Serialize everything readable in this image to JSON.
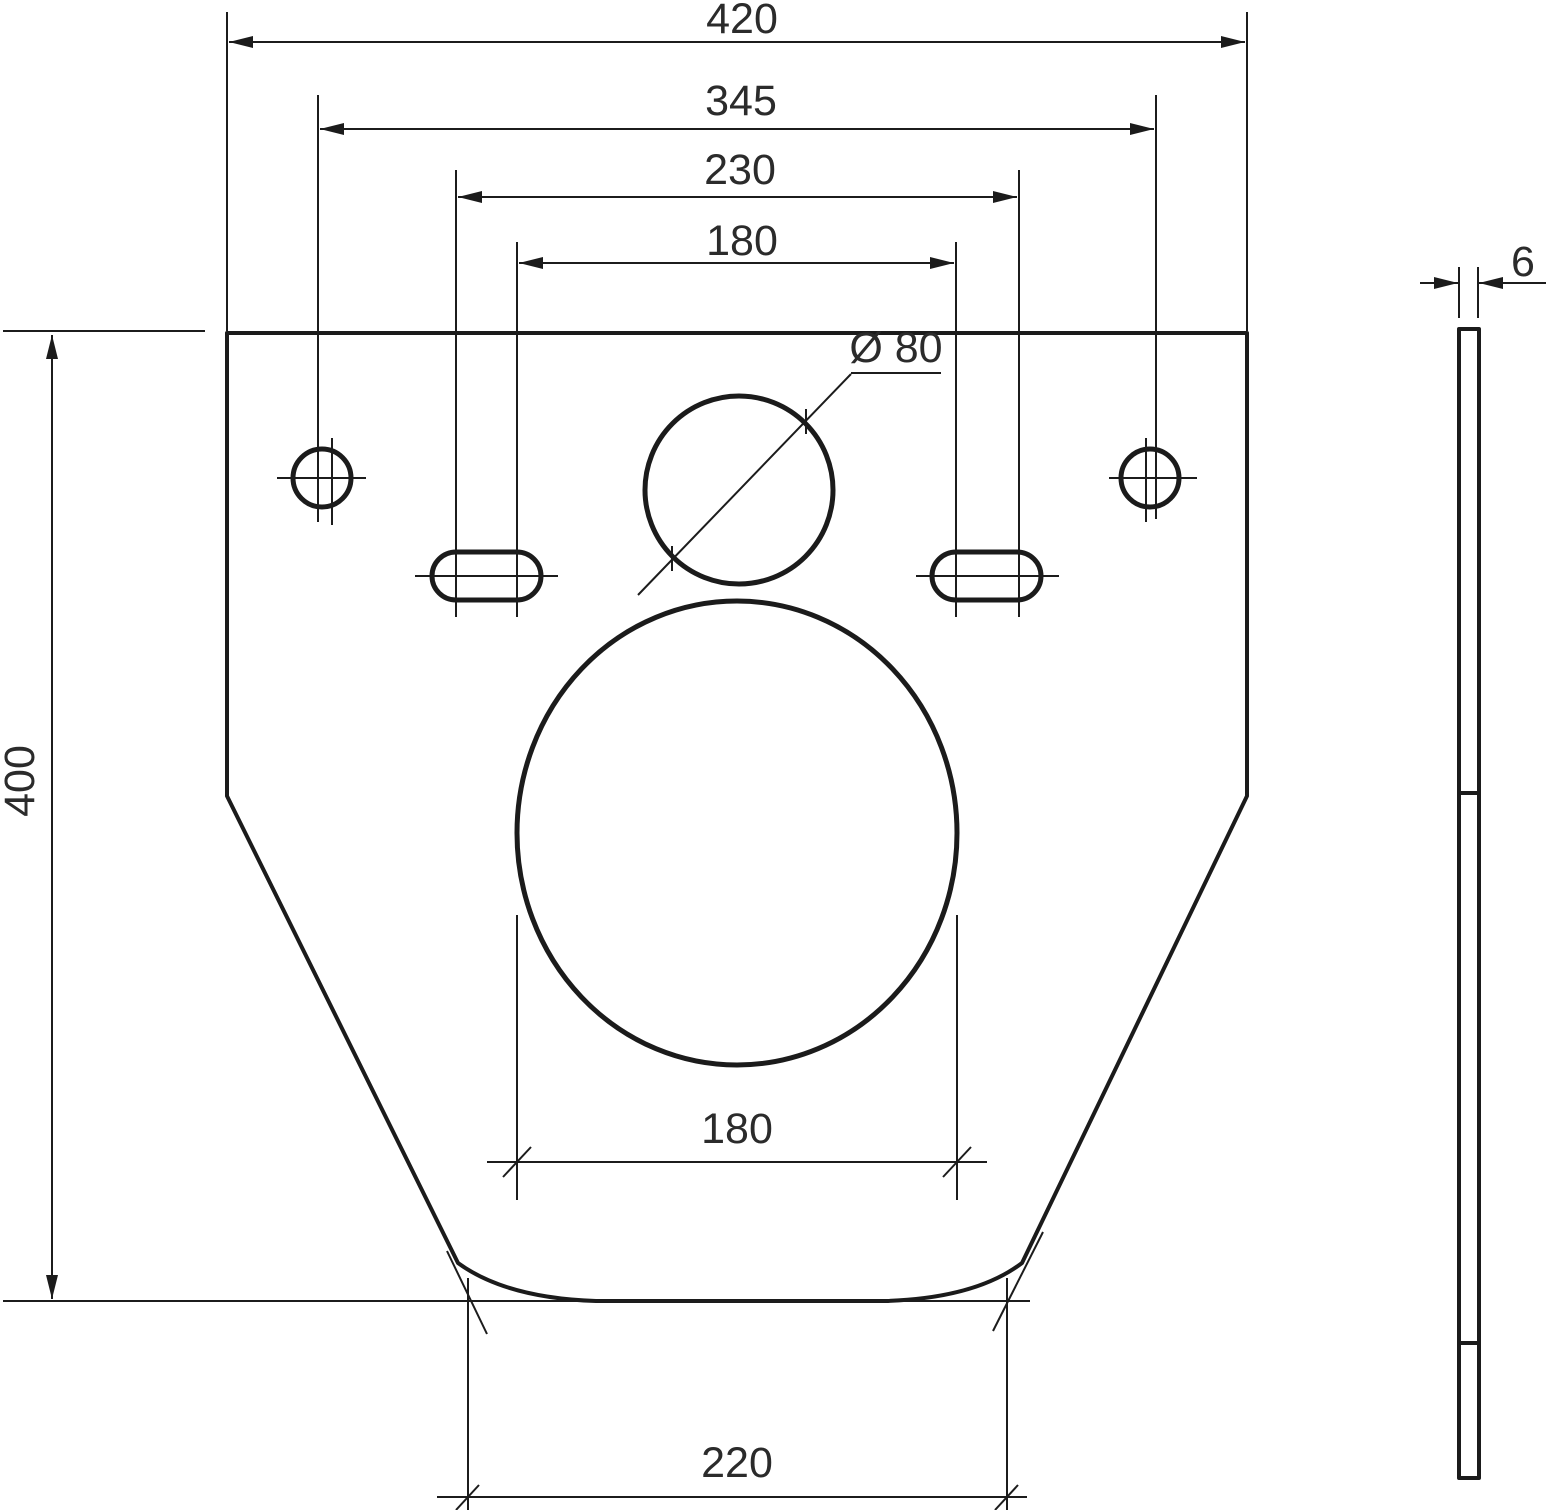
{
  "drawing": {
    "kind": "technical dimension drawing",
    "subject": "trapezoidal mounting plate with pipe hole, oval slots and large opening; thin side view at right",
    "units": "mm",
    "ink_color": "#1b1b1b",
    "background_color": "#ffffff"
  },
  "labels": {
    "overall_width": "420",
    "hole_centers": "345",
    "slot_centers_outer": "230",
    "slot_centers_inner": "180",
    "overall_height": "400",
    "pipe_hole_diameter": "Ø 80",
    "opening_width": "180",
    "base_width": "220",
    "thickness": "6"
  },
  "dimensions": [
    {
      "id": "overall-width",
      "value": "420",
      "orientation": "horizontal"
    },
    {
      "id": "hole-centers-spacing",
      "value": "345",
      "orientation": "horizontal"
    },
    {
      "id": "slot-centers-outer",
      "value": "230",
      "orientation": "horizontal"
    },
    {
      "id": "slot-centers-inner",
      "value": "180",
      "orientation": "horizontal"
    },
    {
      "id": "overall-height",
      "value": "400",
      "orientation": "vertical"
    },
    {
      "id": "pipe-hole-diameter",
      "value": "Ø 80",
      "orientation": "leader"
    },
    {
      "id": "opening-width",
      "value": "180",
      "orientation": "horizontal"
    },
    {
      "id": "base-width",
      "value": "220",
      "orientation": "horizontal"
    },
    {
      "id": "thickness",
      "value": "6",
      "orientation": "horizontal"
    }
  ]
}
